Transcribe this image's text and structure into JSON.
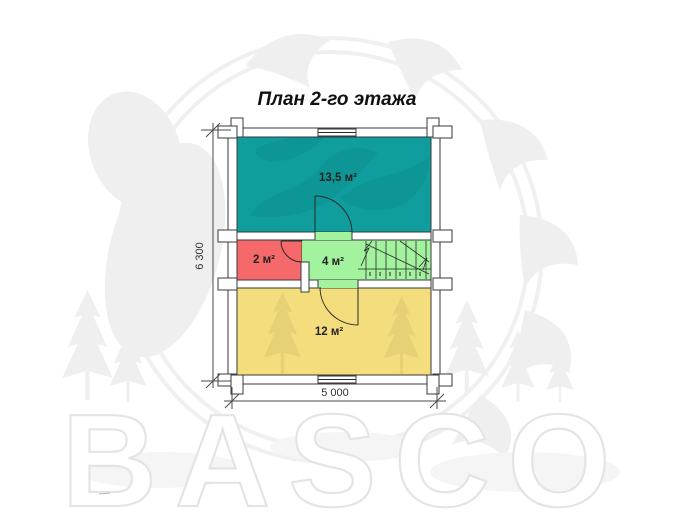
{
  "page": {
    "title": "План 2-го этажа",
    "watermark": "BASCO"
  },
  "plan": {
    "rooms": [
      {
        "id": "room-top",
        "area_label": "13,5 м²",
        "color": "#0f9d9d"
      },
      {
        "id": "room-left",
        "area_label": "2 м²",
        "color": "#f5696b"
      },
      {
        "id": "room-hall",
        "area_label": "4 м²",
        "color": "#a2f29e"
      },
      {
        "id": "room-bottom",
        "area_label": "12 м²",
        "color": "#f4dd7d"
      }
    ],
    "dimensions": {
      "height_mm": "6 300",
      "width_mm": "5 000"
    }
  }
}
